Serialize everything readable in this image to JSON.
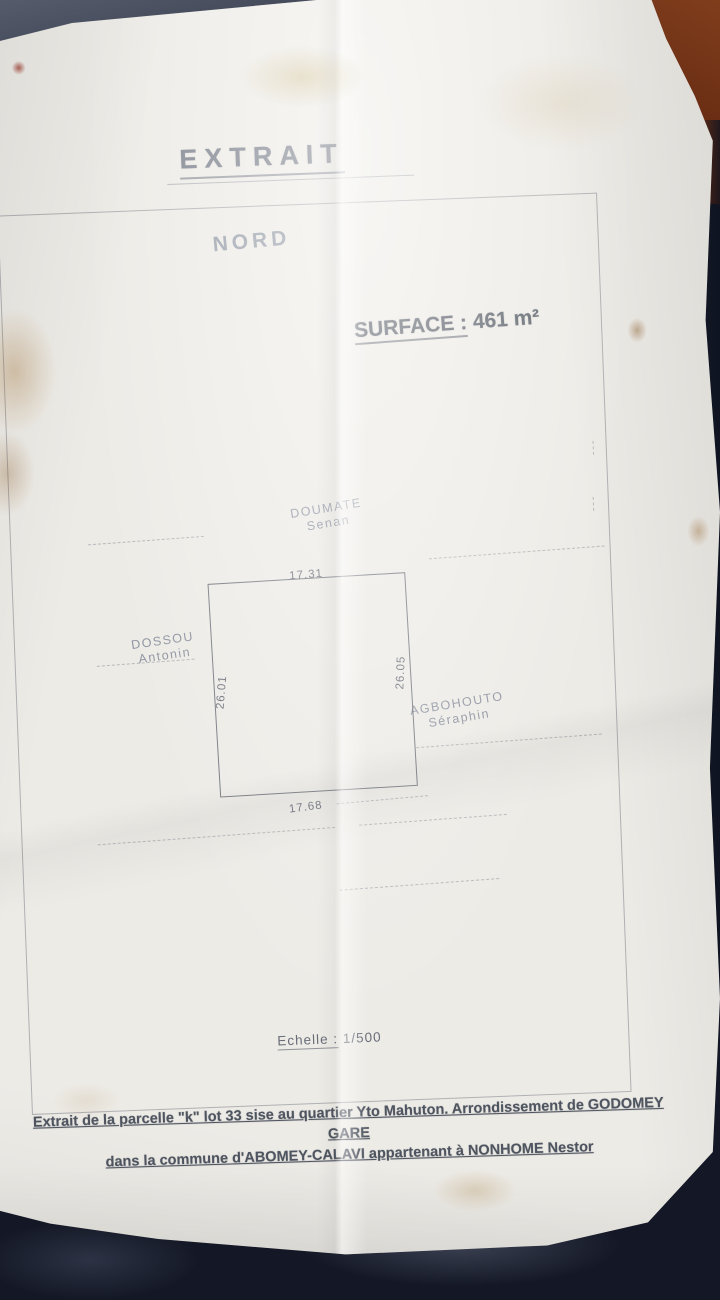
{
  "photo": {
    "paper_color": "#edebe6",
    "background_color": "#141826",
    "fabric_topleft_color": "#5b6170",
    "fabric_topright_color": "#8a4420",
    "ink_color": "#6f747d"
  },
  "document": {
    "title": "EXTRAIT",
    "north_label": "NORD",
    "surface_label": "SURFACE :",
    "surface_value": "461 m²",
    "parcel": {
      "dim_top": "17.31",
      "dim_bottom": "17.68",
      "dim_left": "26.01",
      "dim_right": "26.05"
    },
    "neighbors": [
      {
        "side": "north",
        "name": "DOUMATE",
        "firstname": "Senan"
      },
      {
        "side": "west",
        "name": "DOSSOU",
        "firstname": "Antonin"
      },
      {
        "side": "east",
        "name": "AGBOHOUTO",
        "firstname": "Séraphin"
      }
    ],
    "scale_label": "Echelle :",
    "scale_value": "1/500",
    "footer_line1": "Extrait de la parcelle \"k\" lot 33 sise au quartier Yto Mahuton. Arrondissement de GODOMEY GARE",
    "footer_line2": "dans la commune d'ABOMEY-CALAVI appartenant à NONHOME Nestor"
  }
}
